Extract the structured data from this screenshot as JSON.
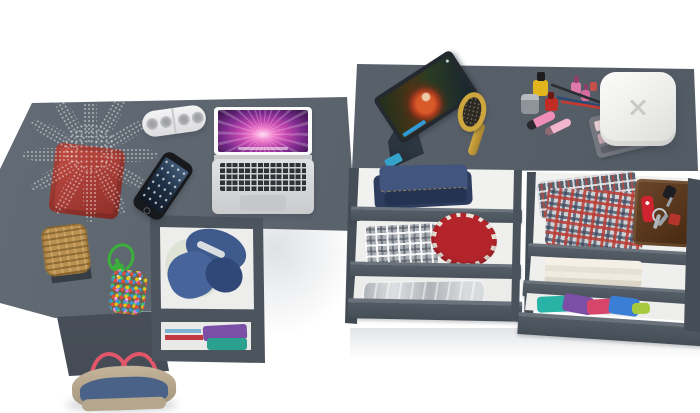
{
  "labels": {
    "scene": "top-down view of graphite corner desk and vanity dresser with open drawers",
    "desk": "graphite corner desk",
    "desk_storage": "desk storage compartments with denim and folded clothes",
    "plant": "green potted plant in red square pot",
    "speaker": "white portable pill speaker",
    "laptop": "open silver laptop with pink aurora wallpaper",
    "phone": "black smartphone",
    "basket": "wicker basket on dark tray",
    "pompom_bag": "bead pouch with green drawstring cord",
    "handbag": "denim and tan tote bag with pink handles",
    "vanity": "graphite vanity dresser top",
    "tablet": "tablet on stand playing a movie",
    "hairbrush": "gold hairbrush",
    "cosmetics": "makeup set with nail polish, lipstick, pencils and eyeshadow palette",
    "jewelry_box": "white rounded jewelry box with x mark",
    "drawer_stack_left": "open drawers with jeans, plaid shirt, red hat and storage bag",
    "drawer_stack_right": "open drawers with plaid shirts, leather folio, knife, keys, towels and colorful clothes"
  },
  "palette": {
    "floor": "#ffffff",
    "desk-top": "#59616b",
    "desk-top-light": "#636b75",
    "desk-side": "#4b525b",
    "frame-dark": "#4c545d",
    "bar-light": "#6b737c",
    "bar-mid": "#555d67",
    "bar-dark": "#49515a",
    "interior": "#efefee",
    "pot-red": "#b0413a",
    "leaf-dark": "#3e7226",
    "speaker-white": "#ececee",
    "phone-black": "#17191d",
    "basket-tan": "#b9904f",
    "tray-dark": "#363d44",
    "cord-green": "#3cae3c",
    "jeans-dark": "#2e3d5e",
    "jeans-mid": "#41557e",
    "plaid-gray": "#aab0b5",
    "hat-red": "#b3252b",
    "hat-white": "#ece5da",
    "folio-brown": "#5a3922",
    "knife-red": "#cf2430",
    "teal": "#28b3a6",
    "purple": "#7b4fa5",
    "white-fabric": "#dfe3d6",
    "bag-denim": "#4a6287",
    "bag-tan": "#b5a68e",
    "handle-pink": "#e25669",
    "brush-gold": "#cda63e",
    "stand-blue": "#35a3c9",
    "polish-yellow": "#e2b41e",
    "polish-red": "#c02d24",
    "polish-pink": "#e079ac",
    "lip-pink": "#ef8fb8",
    "pencil-black": "#2c2f34",
    "pencil-blue": "#2a4a74",
    "pencil-red": "#c23a30"
  }
}
